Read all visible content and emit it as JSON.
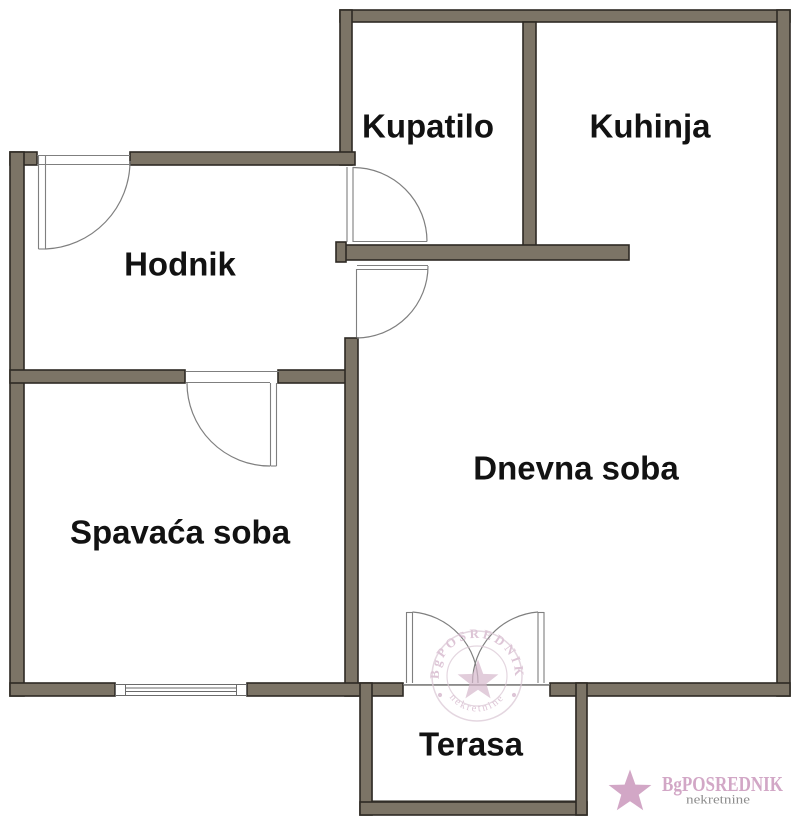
{
  "floorplan": {
    "canvas": {
      "w": 800,
      "h": 827,
      "bg": "#ffffff"
    },
    "colors": {
      "wall_fill": "#7c7466",
      "wall_stroke": "#2e2a24",
      "door_line": "#7f7f7f",
      "window_line": "#6a6a6a",
      "terrace_line": "#44403a",
      "label": "#121212",
      "watermark_ring": "#d9c6d3",
      "watermark_text": "#cfadc5",
      "watermark_star": "#d6b8cc",
      "logo_pink": "#d2a7c6",
      "logo_gray": "#8d8d8d"
    },
    "rooms": [
      {
        "label": "Kupatilo",
        "cx": 428,
        "cy": 126
      },
      {
        "label": "Kuhinja",
        "cx": 650,
        "cy": 126
      },
      {
        "label": "Hodnik",
        "cx": 180,
        "cy": 264
      },
      {
        "label": "Dnevna soba",
        "cx": 576,
        "cy": 468
      },
      {
        "label": "Spavaća soba",
        "cx": 180,
        "cy": 532
      },
      {
        "label": "Terasa",
        "cx": 471,
        "cy": 744
      }
    ],
    "walls": [
      {
        "name": "top-wall",
        "x": 340,
        "y": 10,
        "w": 450,
        "h": 12
      },
      {
        "name": "right-wall",
        "x": 777,
        "y": 10,
        "w": 13,
        "h": 686
      },
      {
        "name": "upper-left-wall",
        "x": 340,
        "y": 10,
        "w": 12,
        "h": 155
      },
      {
        "name": "kupatilo-kuhinja-wall",
        "x": 523,
        "y": 22,
        "w": 13,
        "h": 225
      },
      {
        "name": "below-kupatilo-wall",
        "x": 337,
        "y": 245,
        "w": 292,
        "h": 15
      },
      {
        "name": "below-kupatilo-cap",
        "x": 336,
        "y": 242,
        "w": 10,
        "h": 20
      },
      {
        "name": "hodnik-top-wall-left",
        "x": 10,
        "y": 152,
        "w": 27,
        "h": 13
      },
      {
        "name": "hodnik-top-wall-right",
        "x": 130,
        "y": 152,
        "w": 225,
        "h": 13
      },
      {
        "name": "left-wall",
        "x": 10,
        "y": 152,
        "w": 14,
        "h": 544
      },
      {
        "name": "spavaca-top-wall-left",
        "x": 10,
        "y": 370,
        "w": 175,
        "h": 13
      },
      {
        "name": "spavaca-top-wall-right",
        "x": 278,
        "y": 370,
        "w": 77,
        "h": 13
      },
      {
        "name": "spavaca-dnevna-wall",
        "x": 345,
        "y": 338,
        "w": 13,
        "h": 358
      },
      {
        "name": "bottom-wall-left",
        "x": 10,
        "y": 683,
        "w": 105,
        "h": 13
      },
      {
        "name": "bottom-wall-mid",
        "x": 247,
        "y": 683,
        "w": 156,
        "h": 13
      },
      {
        "name": "bottom-wall-right",
        "x": 550,
        "y": 683,
        "w": 240,
        "h": 13
      },
      {
        "name": "terrace-wall-left",
        "x": 360,
        "y": 683,
        "w": 12,
        "h": 132
      },
      {
        "name": "terrace-wall-bottom",
        "x": 360,
        "y": 802,
        "w": 227,
        "h": 13
      },
      {
        "name": "terrace-wall-right",
        "x": 576,
        "y": 683,
        "w": 11,
        "h": 132
      }
    ],
    "terrace_inner": {
      "x": 372,
      "y": 685,
      "w": 204,
      "h": 116
    },
    "window": {
      "outer": {
        "x": 115.5,
        "y": 684.5,
        "w": 131,
        "h": 11
      },
      "jambs_x": [
        125.5,
        236.5
      ],
      "glass_y": [
        688,
        691.5
      ]
    },
    "door_lines": [
      [
        37,
        155.5,
        130,
        155.5
      ],
      [
        37,
        164.5,
        130,
        164.5
      ],
      [
        38.5,
        155,
        38.5,
        249
      ],
      [
        45.5,
        155,
        45.5,
        249
      ],
      [
        38.5,
        249,
        45.5,
        249
      ],
      [
        347,
        167,
        347,
        242
      ],
      [
        353,
        167,
        353,
        242
      ],
      [
        353,
        241.5,
        427,
        241.5
      ],
      [
        357,
        265.5,
        428,
        265.5
      ],
      [
        357,
        269.5,
        428,
        269.5
      ],
      [
        356.5,
        269,
        356.5,
        337
      ],
      [
        186,
        371.5,
        279,
        371.5
      ],
      [
        186,
        382.5,
        270,
        382.5
      ],
      [
        270.5,
        383,
        270.5,
        466
      ],
      [
        276.5,
        383,
        276.5,
        466
      ],
      [
        270.5,
        466,
        276.5,
        466
      ],
      [
        406.5,
        612,
        406.5,
        683
      ],
      [
        412.5,
        612,
        412.5,
        683
      ],
      [
        406.5,
        612.5,
        412.5,
        612.5
      ],
      [
        538,
        612,
        538,
        683
      ],
      [
        544,
        612,
        544,
        683
      ],
      [
        538,
        612.5,
        544,
        612.5
      ],
      [
        403,
        684.7,
        550,
        684.7
      ]
    ],
    "door_arcs": [
      "M 45.5 249 A 88 88 0 0 0 130 161",
      "M 427 241.5 A 74 74 0 0 0 353 167.5",
      "M 428 266 A 72 72 0 0 1 357 338",
      "M 187 382.5 A 83 83 0 0 0 270 466",
      "M 412.5 612 A 71 71 0 0 1 478 683",
      "M 538 612 A 71 71 0 0 0 472.5 683"
    ]
  },
  "watermark": {
    "brand": "BgPOSREDNIK",
    "tagline": "nekretnine",
    "cx": 477,
    "cy": 676,
    "outer_r": 45,
    "inner_r": 30,
    "top_text_path": "M 441.3 689 A 38 38 0 1 1 512.7 689",
    "bottom_text_path": "M 445.4 690 A 34 34 0 0 0 508.6 690",
    "star": {
      "cx": 478,
      "cy": 681,
      "R": 21.5,
      "r": 8.8
    },
    "dots": [
      [
        440,
        695
      ],
      [
        514,
        695
      ]
    ]
  },
  "logo": {
    "brand": "BgPOSREDNIK",
    "tagline": "nekretnine",
    "star": {
      "cx": 630,
      "cy": 792,
      "R": 22.5,
      "r": 9.2
    }
  }
}
